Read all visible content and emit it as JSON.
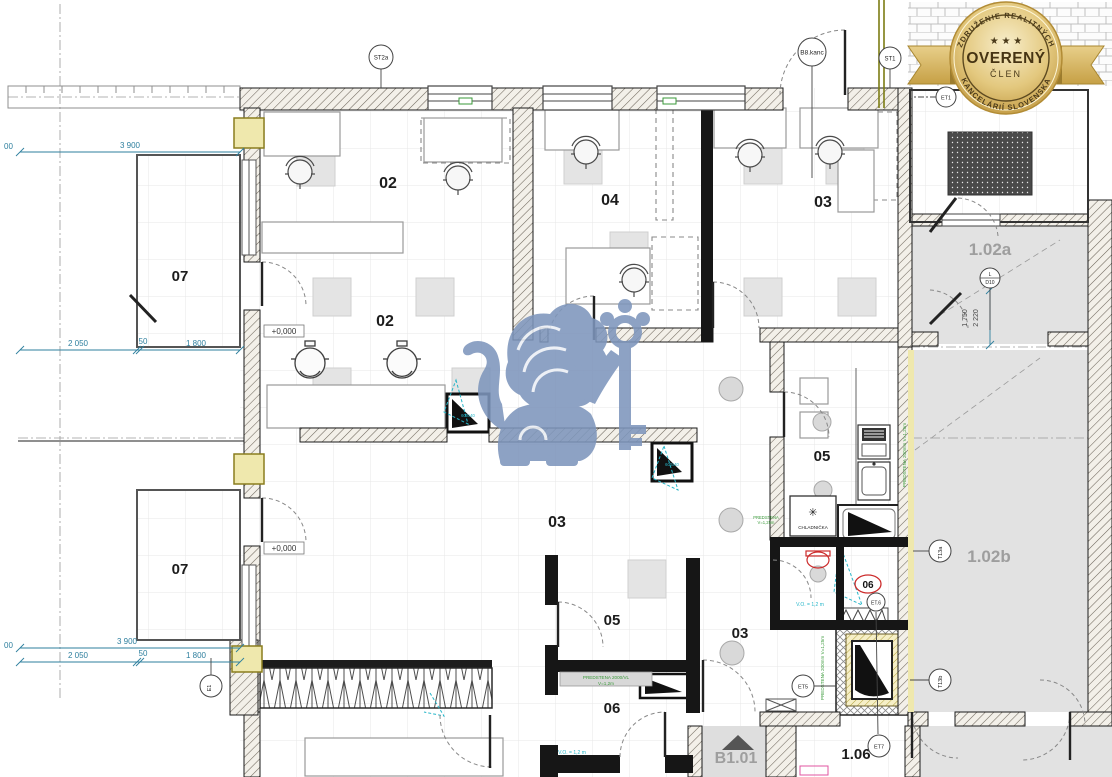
{
  "badge": {
    "arc_top": "ZDRUŽENIE REALITNÝCH",
    "arc_bottom": "KANCELÁRIÍ SLOVENSKA",
    "main": "OVERENÝ",
    "sub": "ČLEN",
    "stars": "★ ★ ★"
  },
  "rooms": {
    "office_top_left": "02",
    "office_top_mid": "04",
    "office_top_right": "03",
    "office_left": "02",
    "balcony_upper": "07",
    "balcony_lower": "07",
    "hall_main": "03",
    "kitchen": "05",
    "room_small_a": "05",
    "hall_lower": "03",
    "room_small_b": "06",
    "wc_room": "06",
    "unit_102a": "1.02a",
    "unit_102b": "1.02b",
    "unit_106": "1.06",
    "stair_b101": "B1.01"
  },
  "markers": {
    "st2a": "ST2a",
    "b8kanc": "B8.kanc",
    "st1": "ST1",
    "et1": "ET1",
    "d10_top": "L",
    "d10_bottom": "D10",
    "t13a": "T13a",
    "t13b": "T13b",
    "et5": "ET5",
    "et6": "ET.6",
    "et7": "ET7",
    "e1": "E1",
    "wc_tag": "06"
  },
  "dimensions": {
    "w3900": "3 900",
    "w2050": "2 050",
    "w50": "50",
    "w1800": "1 800",
    "edge": "00",
    "h1750": "1 750",
    "h2220": "2 220"
  },
  "levels": {
    "zero": "+0,000"
  },
  "notes": {
    "fridge": "CHLADNIČKA",
    "fridge_icon": "✳",
    "clear_height": "V.O. = 1,2 m",
    "partition_a1": "PREDSTENA 2000/VL",
    "partition_a2": "V=1,2m",
    "partition_b1": "PREDSTENA",
    "partition_b2": "V=1,25m",
    "partition_c": "PREDSTENA 200mm V=1,25m",
    "niche": "600x40"
  },
  "colors": {
    "dim": "#2e7f9e",
    "green": "#3a9a3a",
    "cyan": "#27b6c9",
    "red": "#cc2b2b",
    "gray_label": "#9e9e9e",
    "wall": "#141414",
    "gold": "#c9a44d",
    "watermark": "#7e96bc"
  }
}
